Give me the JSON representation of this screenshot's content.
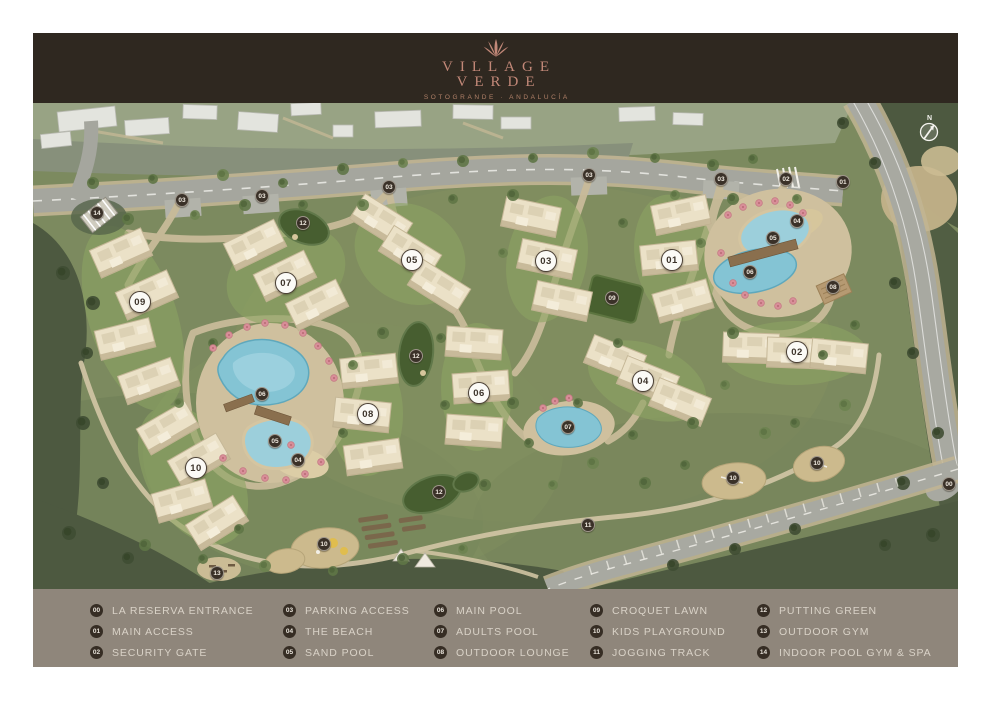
{
  "header": {
    "background": "#2f2820",
    "accent": "#c28878",
    "title_line1": "VILLAGE",
    "title_line2": "VERDE",
    "subtitle": "SOTOGRANDE · ANDALUCÍA"
  },
  "map": {
    "compass": {
      "label": "N"
    },
    "building_markers": [
      {
        "label": "01",
        "x": 639,
        "y": 157
      },
      {
        "label": "02",
        "x": 764,
        "y": 249
      },
      {
        "label": "03",
        "x": 513,
        "y": 158
      },
      {
        "label": "04",
        "x": 610,
        "y": 278
      },
      {
        "label": "05",
        "x": 379,
        "y": 157
      },
      {
        "label": "06",
        "x": 446,
        "y": 290
      },
      {
        "label": "07",
        "x": 253,
        "y": 180
      },
      {
        "label": "08",
        "x": 335,
        "y": 311
      },
      {
        "label": "09",
        "x": 107,
        "y": 199
      },
      {
        "label": "10",
        "x": 163,
        "y": 365
      }
    ],
    "amenity_markers": [
      {
        "label": "00",
        "x": 916,
        "y": 381
      },
      {
        "label": "01",
        "x": 810,
        "y": 79
      },
      {
        "label": "02",
        "x": 753,
        "y": 76
      },
      {
        "label": "03",
        "x": 149,
        "y": 97
      },
      {
        "label": "03",
        "x": 229,
        "y": 93
      },
      {
        "label": "03",
        "x": 356,
        "y": 84
      },
      {
        "label": "03",
        "x": 556,
        "y": 72
      },
      {
        "label": "03",
        "x": 688,
        "y": 76
      },
      {
        "label": "04",
        "x": 764,
        "y": 118
      },
      {
        "label": "04",
        "x": 265,
        "y": 357
      },
      {
        "label": "05",
        "x": 740,
        "y": 135
      },
      {
        "label": "05",
        "x": 242,
        "y": 338
      },
      {
        "label": "06",
        "x": 717,
        "y": 169
      },
      {
        "label": "06",
        "x": 229,
        "y": 291
      },
      {
        "label": "07",
        "x": 535,
        "y": 324
      },
      {
        "label": "08",
        "x": 800,
        "y": 184
      },
      {
        "label": "09",
        "x": 579,
        "y": 195
      },
      {
        "label": "10",
        "x": 291,
        "y": 441
      },
      {
        "label": "10",
        "x": 700,
        "y": 375
      },
      {
        "label": "10",
        "x": 784,
        "y": 360
      },
      {
        "label": "11",
        "x": 555,
        "y": 422
      },
      {
        "label": "12",
        "x": 270,
        "y": 120
      },
      {
        "label": "12",
        "x": 383,
        "y": 253
      },
      {
        "label": "12",
        "x": 406,
        "y": 389
      },
      {
        "label": "13",
        "x": 184,
        "y": 470
      },
      {
        "label": "14",
        "x": 64,
        "y": 110
      }
    ]
  },
  "legend": {
    "background": "#8f867b",
    "badge_color": "#362d24",
    "text_color": "#d9d2c7",
    "columns": [
      {
        "x": 57,
        "items": [
          {
            "num": "00",
            "label": "LA RESERVA ENTRANCE"
          },
          {
            "num": "01",
            "label": "MAIN ACCESS"
          },
          {
            "num": "02",
            "label": "SECURITY GATE"
          }
        ]
      },
      {
        "x": 250,
        "items": [
          {
            "num": "03",
            "label": "PARKING ACCESS"
          },
          {
            "num": "04",
            "label": "THE BEACH"
          },
          {
            "num": "05",
            "label": "SAND POOL"
          }
        ]
      },
      {
        "x": 401,
        "items": [
          {
            "num": "06",
            "label": "MAIN POOL"
          },
          {
            "num": "07",
            "label": "ADULTS POOL"
          },
          {
            "num": "08",
            "label": "OUTDOOR LOUNGE"
          }
        ]
      },
      {
        "x": 557,
        "items": [
          {
            "num": "09",
            "label": "CROQUET LAWN"
          },
          {
            "num": "10",
            "label": "KIDS PLAYGROUND"
          },
          {
            "num": "11",
            "label": "JOGGING TRACK"
          }
        ]
      },
      {
        "x": 724,
        "items": [
          {
            "num": "12",
            "label": "PUTTING GREEN"
          },
          {
            "num": "13",
            "label": "OUTDOOR GYM"
          },
          {
            "num": "14",
            "label": "INDOOR POOL GYM & SPA"
          }
        ]
      }
    ]
  }
}
